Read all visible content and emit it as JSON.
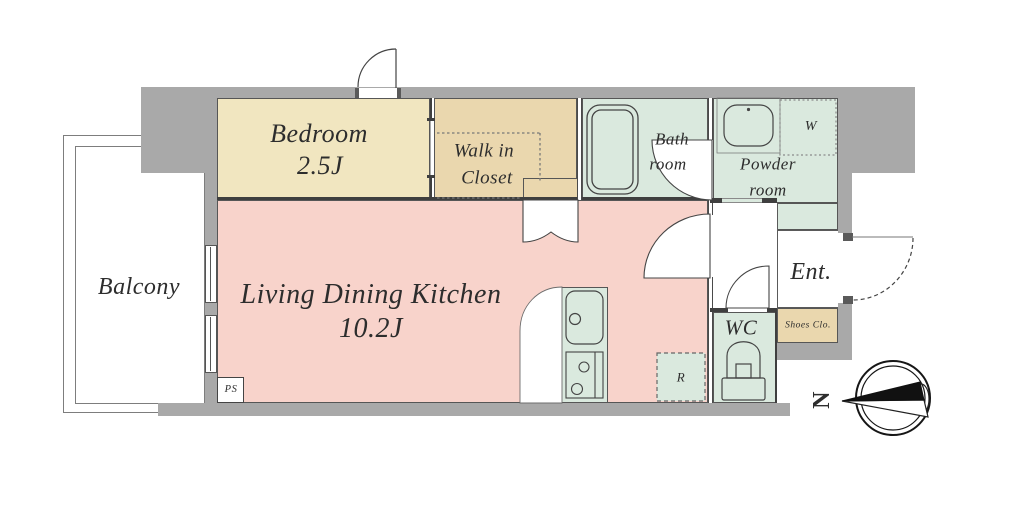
{
  "title": "1K apartment floor plan",
  "rooms": {
    "bedroom": {
      "name": "Bedroom",
      "size": "2.5J"
    },
    "walk_in_closet": {
      "line1": "Walk in",
      "line2": "Closet"
    },
    "ldk": {
      "name": "Living Dining Kitchen",
      "size": "10.2J"
    },
    "balcony": {
      "name": "Balcony"
    },
    "bathroom": {
      "line1": "Bath",
      "line2": "room"
    },
    "powder_room": {
      "line1": "Powder",
      "line2": "room"
    },
    "wc": {
      "name": "WC"
    },
    "entrance": {
      "name": "Ent."
    },
    "shoes_closet": {
      "name": "Shoes Clo."
    }
  },
  "markers": {
    "washer": "W",
    "refrigerator": "R",
    "pipe_space": "PS",
    "compass_north": "N"
  },
  "colors": {
    "wall": "#a9a9a9",
    "bedroom": "#f1e6c0",
    "closet": "#ead7ae",
    "ldk": "#f8d3cb",
    "wet": "#dae9de",
    "line": "#3f3f3f"
  }
}
